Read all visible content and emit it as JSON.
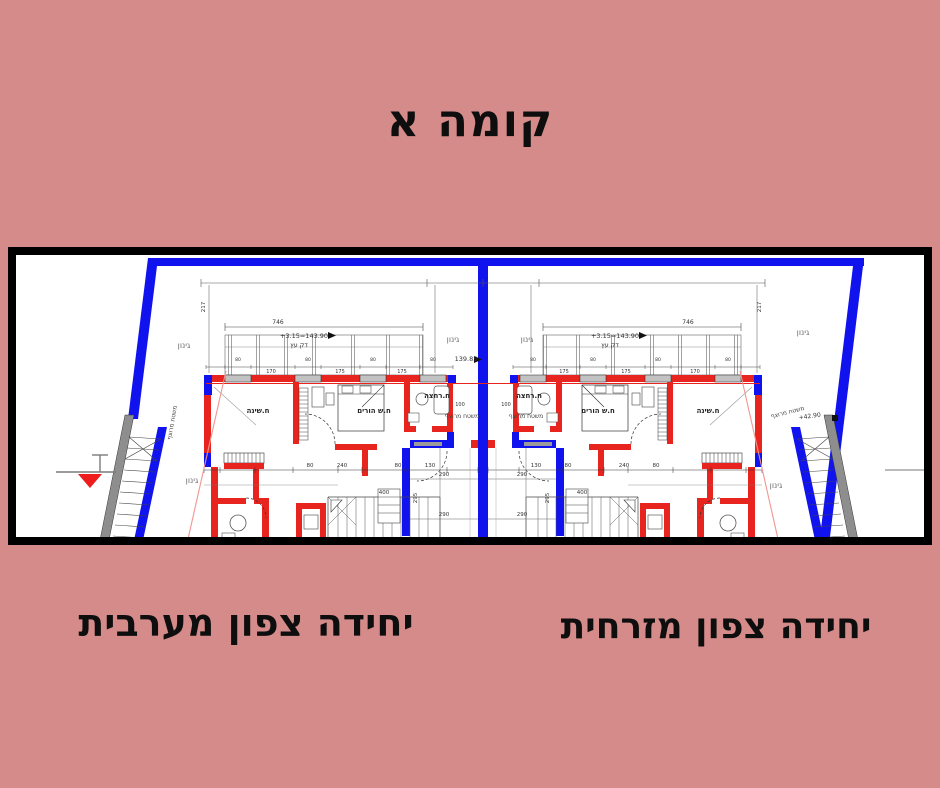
{
  "page": {
    "title": "קומה א",
    "background_color": "#d48b89"
  },
  "units": {
    "west_label": "יחידה צפון מערבית",
    "east_label": "יחידה צפון מזרחית"
  },
  "plan": {
    "labels": {
      "garden": "גינון",
      "paved": "משטח מרוצף",
      "bath": "ח.רחצה",
      "parents": "ח.ש הורים",
      "bedroom": "ח.שינה",
      "deck": "דק עץ",
      "level_plus": "+3.15=143.90",
      "level_center": "139.85",
      "level_right": "+42.90"
    },
    "dims": {
      "d746": "746",
      "d217": "217",
      "d80": "80",
      "d240": "240",
      "d130": "130",
      "d170": "170",
      "d175": "175",
      "d290": "290",
      "d295": "295",
      "d400": "400",
      "d100": "100"
    },
    "colors": {
      "wall_red": "#e8241f",
      "boundary_blue": "#1013ee",
      "setback_pink": "#f2968f",
      "line_gray": "#555555"
    }
  }
}
